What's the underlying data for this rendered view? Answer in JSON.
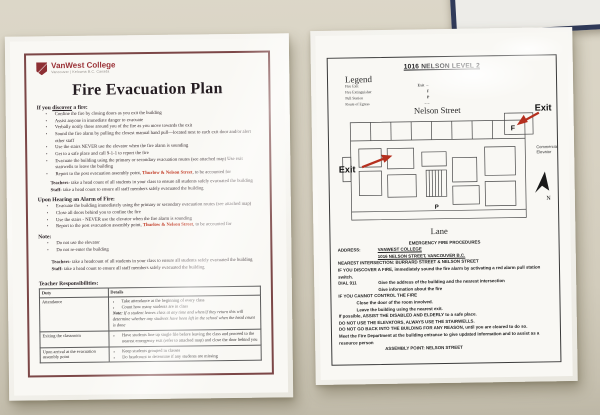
{
  "colors": {
    "wall": "#d7d1c2",
    "maroon_border": "#7c4747",
    "brand_maroon": "#9a3136",
    "highlight_red": "#c23a24",
    "arrow_red": "#b5301f",
    "frame_navy": "#303a59"
  },
  "left_doc": {
    "brand": {
      "name": "VanWest College",
      "tagline": "Vancouver | Kelowna   B.C. Canada"
    },
    "title": "Fire Evacuation Plan",
    "discover": {
      "heading_pre": "If you ",
      "heading_underline": "discover",
      "heading_post": " a fire:",
      "items": [
        "Confine the fire by closing doors as you exit the building",
        "Assist anyone in immediate danger to evacuate",
        "Verbally notify those around you of the fire as you move towards the exit",
        "Sound the fire alarm by pulling the closest manual hand pull—located next to each exit door and/or alert other staff",
        "Use the stairs NEVER use the elevator when the fire alarm is sounding",
        "Get to a safe place and call 9-1-1 to report the fire",
        "Evacuate the building using the primary or secondary evacuation routes (see attached map) Use exit stairwells to leave the building"
      ],
      "report": {
        "pre": "Report to the post evacuation assembly point, ",
        "highlight": "Thurlow & Nelson Street",
        "post": ", to be accounted for"
      }
    },
    "headcount_1": {
      "teachers_label": "Teachers-",
      "teachers_text": " take a head count of all students in your class to ensure all students safely evacuated the building",
      "staff_label": "Staff-",
      "staff_text": " take a head count to ensure all staff members safely evacuated the building"
    },
    "alarm": {
      "heading": "Upon Hearing an Alarm of Fire:",
      "items": [
        "Evacuate the building immediately using the primary or secondary evacuation routes (see attached map)",
        "Close all doors behind you to confine the fire",
        "Use the stairs - NEVER use the elevator when the fire alarm is sounding"
      ],
      "report": {
        "pre": "Report to the post evacuation assembly point, ",
        "highlight": "Thurlow & Nelson Street",
        "post": ", to be accounted for"
      }
    },
    "note": {
      "heading": "Note:",
      "items": [
        "Do not use the elevator",
        "Do not re-enter the building"
      ]
    },
    "headcount_2": {
      "teachers_label": "Teachers-",
      "teachers_text": " take a headcount of all students in your class to ensure all students safely evacuated the building",
      "staff_label": "Staff-",
      "staff_text": " take a head count to ensure all staff members safely evacuated the building"
    },
    "responsibilities": {
      "heading": "Teacher Responsibilities:",
      "columns": [
        "Duty",
        "Details"
      ],
      "rows": [
        {
          "duty": "Attendance",
          "bullet_0": "Take attendance at the beginning of every class",
          "bullet_1": "Count how many students are in class",
          "note_label": "Note:",
          "note_text": " If a student leaves class at any time and when/if they return this will determine whether any students have been left in the school when the head count is done"
        },
        {
          "duty": "Exiting the classroom",
          "bullet_0": "Have students line up single file before leaving the class and proceed to the nearest emergency exit (refer to attached map) and close the door behind you"
        },
        {
          "duty": "Upon arrival at the evacuation assembly point",
          "bullet_0": "Keep students grouped in classes",
          "bullet_1": "Do headcount to determine if any students are missing"
        }
      ]
    }
  },
  "right_doc": {
    "title": "1016 NELSON LEVEL 2",
    "legend": {
      "heading": "Legend",
      "items": [
        {
          "label": "Fire Exit",
          "symbol": "Exit →"
        },
        {
          "label": "Fire Extinguisher",
          "symbol": "F"
        },
        {
          "label": "Pull Station",
          "symbol": "P"
        },
        {
          "label": "Route of Egress",
          "symbol": "– –"
        }
      ]
    },
    "map": {
      "street_top": "Nelson Street",
      "street_bottom": "Lane",
      "exit_label": "Exit",
      "extinguisher_marker": "F",
      "pull_station_marker": "P",
      "elevator_line1": "Commercial",
      "elevator_line2": "Elevator",
      "north_label": "N"
    },
    "procedures": {
      "heading": "EMERGENCY FIRE PROCEDURES",
      "address_label": "ADDRESS:",
      "address_name": "VANWEST COLLEGE",
      "address_street": "1016 NELSON STREET, VANCOUVER B.C.",
      "intersection": "NEAREST INTERSECTION:  BURRARD STREET &  NELSON STREET",
      "discover_line": "IF YOU DISCOVER A FIRE, immediately sound the fire alarm by activating a red alarm pull station switch.",
      "dial_label": "DIAL 911",
      "dial_line1": "Give the address of the building and the nearest intersection",
      "dial_line2": "Give information about the fire",
      "cannot_control": "IF YOU CANNOT CONTROL THE FIRE",
      "close_door": "Close the door of the room involved.",
      "leave_building": "Leave the building using the nearest exit.",
      "assist": "If possible, ASSIST THE DISABLED AND ELDERLY to a safe place.",
      "no_elevators": "DO NOT USE THE ELEVATORS, ALWAYS USE THE STAIRWELLS.",
      "no_reentry": "DO NOT GO BACK INTO THE BUILDING FOR ANY REASON, until you are cleared to do so.",
      "meet_fd": "Meet the Fire Department at the building entrance to give updated information and to assist as a resource person",
      "assembly": "ASSEMBLY POINT:  NELSON STREET"
    }
  }
}
